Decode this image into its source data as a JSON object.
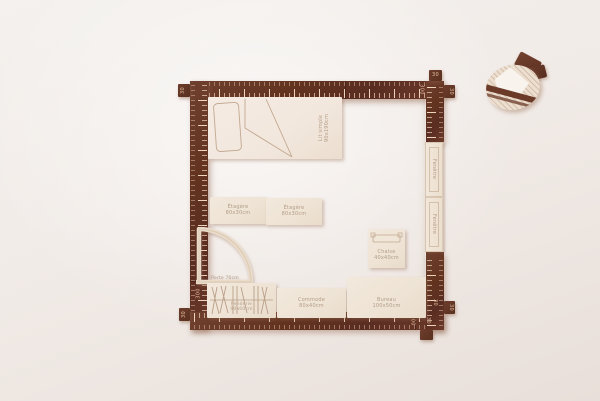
{
  "ruler": {
    "n30": "30",
    "n300": "300"
  },
  "furniture": {
    "bed": {
      "name": "Lit simple",
      "dims": "90x190cm"
    },
    "shelf_left": {
      "name": "Étagère",
      "dims": "80x30cm"
    },
    "shelf_right": {
      "name": "Étagère",
      "dims": "80x30cm"
    },
    "door": {
      "name": "Porte",
      "dims": "70cm"
    },
    "chair": {
      "name": "Chaise",
      "dims": "40x40cm"
    },
    "wardrobe": {
      "name": "Penderie",
      "dims": "90x60cm"
    },
    "dresser": {
      "name": "Commode",
      "dims": "80x40cm"
    },
    "desk": {
      "name": "Bureau",
      "dims": "100x50cm"
    },
    "window_top": {
      "name": "Fenêtre",
      "dims": "70cm"
    },
    "window_bottom": {
      "name": "Fenêtre",
      "dims": "70cm"
    }
  },
  "colors": {
    "background": "#f1ece8",
    "wall_wood": "#62331f",
    "piece_wood": "#eee3d4",
    "engraving": "#b49c86",
    "tick": "#eed1b6"
  }
}
